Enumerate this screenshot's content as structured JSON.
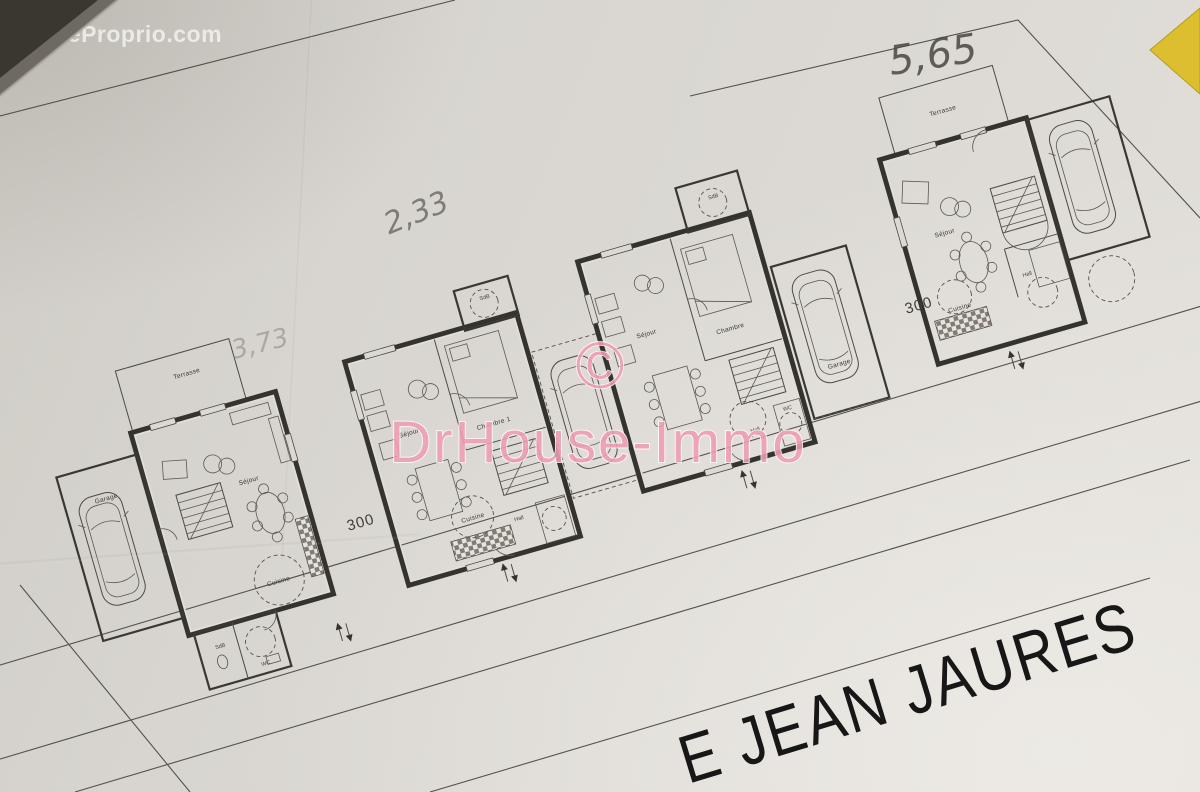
{
  "watermarks": {
    "source": "© EtreProprio.com",
    "agency_symbol": "©",
    "agency": "DrHouse-Immo"
  },
  "street": {
    "name": "E JEAN JAURES"
  },
  "handwritten": {
    "dim_top_right": "5,65",
    "dim_middle": "2,33",
    "dim_left": "3,73"
  },
  "dimensions": {
    "lot_left": "300",
    "lot_right": "300"
  },
  "houses": [
    {
      "name": "house-1",
      "labels": {
        "terrasse": "Terrasse",
        "garage": "Garage",
        "sejour": "Séjour",
        "cuisine": "Cuisine",
        "sdb": "SdB",
        "wc": "WC"
      }
    },
    {
      "name": "house-2",
      "labels": {
        "sejour": "Séjour",
        "chambre": "Chambre 1",
        "sdb": "SdB",
        "cuisine": "Cuisine",
        "hall": "Hall"
      }
    },
    {
      "name": "house-3",
      "labels": {
        "sejour": "Séjour",
        "chambre": "Chambre",
        "sdb": "SdB",
        "garage": "Garage",
        "hall": "Hall",
        "wc": "WC"
      }
    },
    {
      "name": "house-4",
      "labels": {
        "terrasse": "Terrasse",
        "sejour": "Séjour",
        "cuisine": "Cuisine",
        "hall": "Hall"
      }
    }
  ],
  "colors": {
    "paper": "#d8d5d0",
    "ink": "#35332e",
    "watermark_pink": "#f09db3",
    "corner_yellow": "#ddbe2e",
    "street_text": "#171717"
  }
}
